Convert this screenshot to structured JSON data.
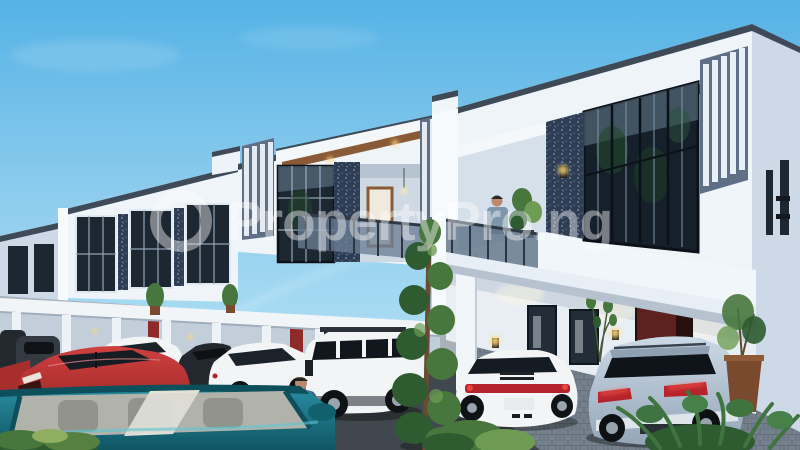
{
  "image": {
    "type": "exterior-3d-architectural-render",
    "width_px": 800,
    "height_px": 450,
    "subject": "Row of modern white two-storey terraced duplex houses with balconies, parked cars, a spiral topiary tree and landscaping under a clear blue sky"
  },
  "watermark": {
    "logo": "ring-circle",
    "text": "PropertyPro.ng",
    "color": "#ffffff",
    "opacity": 0.42
  },
  "colors": {
    "sky_top": "#54b2e5",
    "sky_mid": "#8ecdee",
    "sky_bottom": "#aadcf3",
    "facade_white": "#eff4f9",
    "facade_shade": "#cdd9e6",
    "facade_deep_shade": "#b7c6d8",
    "roof_trim": "#3e4a58",
    "glass_dark": "#1d2731",
    "mosaic_panel": "#2e3d54",
    "wood_soffit": "#8a5a36",
    "door_maroon": "#5c221f",
    "porch_door_red": "#8e2a28",
    "lamp_glow": "#ffd978",
    "road_asphalt": "#41474e",
    "paver_light": "#a9b2ba",
    "paver_blue": "#74808c",
    "foliage_dark": "#2e5b30",
    "foliage_mid": "#47773c",
    "foliage_light": "#6f9c55",
    "trunk_brown": "#6a4a30",
    "pot_brown": "#7a4a2e",
    "car_red": "#c23434",
    "car_teal": "#1f7f92",
    "car_white": "#f2f4f6",
    "car_suv_silver": "#b9c8d7",
    "car_dark": "#23282e",
    "taillight_red": "#b5242c",
    "skin": "#b98a6e",
    "hoodie_blue": "#4a6a94",
    "shirt_slate": "#7d96ab",
    "interior_beige": "#b7b3a6"
  },
  "scene": {
    "sky": {
      "description": "clear blue sky with faint wispy clouds and a thin white contrail"
    },
    "buildings": [
      {
        "name": "terrace-house-right",
        "position": "right foreground, closest",
        "floors": 2,
        "features": [
          "dark parapet trim",
          "wood soffit with recessed downlights",
          "five vertical white fins",
          "full-height glazed window reflecting trees",
          "dark mosaic feature wall with sconce",
          "recessed balcony with glass railing",
          "white balcony parapet",
          "maroon entry door ajar",
          "two ground-floor windows",
          "glowing wall sconces",
          "white porch column"
        ]
      },
      {
        "name": "terrace-house-middle",
        "position": "center",
        "floors": 2,
        "features": [
          "vertical fin screens both sides",
          "gridded feature window",
          "mosaic accent panel",
          "recessed balcony with timber-framed door and pendant light",
          "glass balcony railing",
          "wood soffit with downlights"
        ]
      },
      {
        "name": "terrace-house-left",
        "position": "left, receding",
        "floors": 2,
        "features": [
          "three tall gridded windows",
          "mosaic accent strips",
          "ground-floor colonnade porch with red doors and wall lamps"
        ]
      },
      {
        "name": "terrace-house-far-left",
        "position": "far left edge, most distant",
        "floors": 2,
        "features": [
          "two small dark windows",
          "shared colonnade porch"
        ]
      }
    ],
    "people": [
      {
        "name": "man-on-balcony",
        "description": "man in slate-blue shirt standing at the glass balcony railing beside a potted plant"
      },
      {
        "name": "man-walking",
        "description": "man in a blue hoodie and dark trousers walking across the road near the topiary tree"
      }
    ],
    "cars": [
      {
        "name": "dark-cars-far-left",
        "color_key": "car_dark",
        "view": "partially cropped at left edge"
      },
      {
        "name": "red-sedan",
        "color_key": "car_red",
        "view": "front three-quarter, facing left"
      },
      {
        "name": "white-sedan",
        "color_key": "car_white",
        "view": "side, behind red sedan"
      },
      {
        "name": "dark-coupe",
        "color_key": "car_dark",
        "view": "mostly hidden between white cars"
      },
      {
        "name": "white-coupe",
        "color_key": "car_white",
        "view": "side, facing left"
      },
      {
        "name": "white-range-rover-suv",
        "color_key": "car_white",
        "view": "front three-quarter, boxy SUV with black glasshouse"
      },
      {
        "name": "white-porsche-rear",
        "color_key": "car_white",
        "view": "rear three-quarter with full-width red light bar"
      },
      {
        "name": "silver-blue-suv-rear",
        "color_key": "car_suv_silver",
        "view": "rear three-quarter with red taillights, parked at entrance"
      },
      {
        "name": "teal-car-foreground",
        "color_key": "car_teal",
        "view": "front windshield and hood, cropped at bottom-left corner"
      }
    ],
    "plants": [
      {
        "name": "spiral-topiary-tree",
        "position": "center foreground, full height"
      },
      {
        "name": "bush-bottom-left",
        "position": "bottom-left corner"
      },
      {
        "name": "bush-center",
        "position": "base of topiary tree"
      },
      {
        "name": "fern-bottom-right",
        "position": "bottom-right corner"
      },
      {
        "name": "potted-olive-tree-right",
        "position": "beside right house entrance"
      },
      {
        "name": "porch-potted-plants",
        "position": "along left colonnade"
      },
      {
        "name": "balcony-plant",
        "position": "next to man on balcony"
      },
      {
        "name": "plant-near-door",
        "position": "against right house ground-floor wall"
      }
    ],
    "ground": {
      "areas": [
        "light grey paver forecourt",
        "dark asphalt road",
        "blue-grey paver driveway at right house"
      ]
    }
  }
}
